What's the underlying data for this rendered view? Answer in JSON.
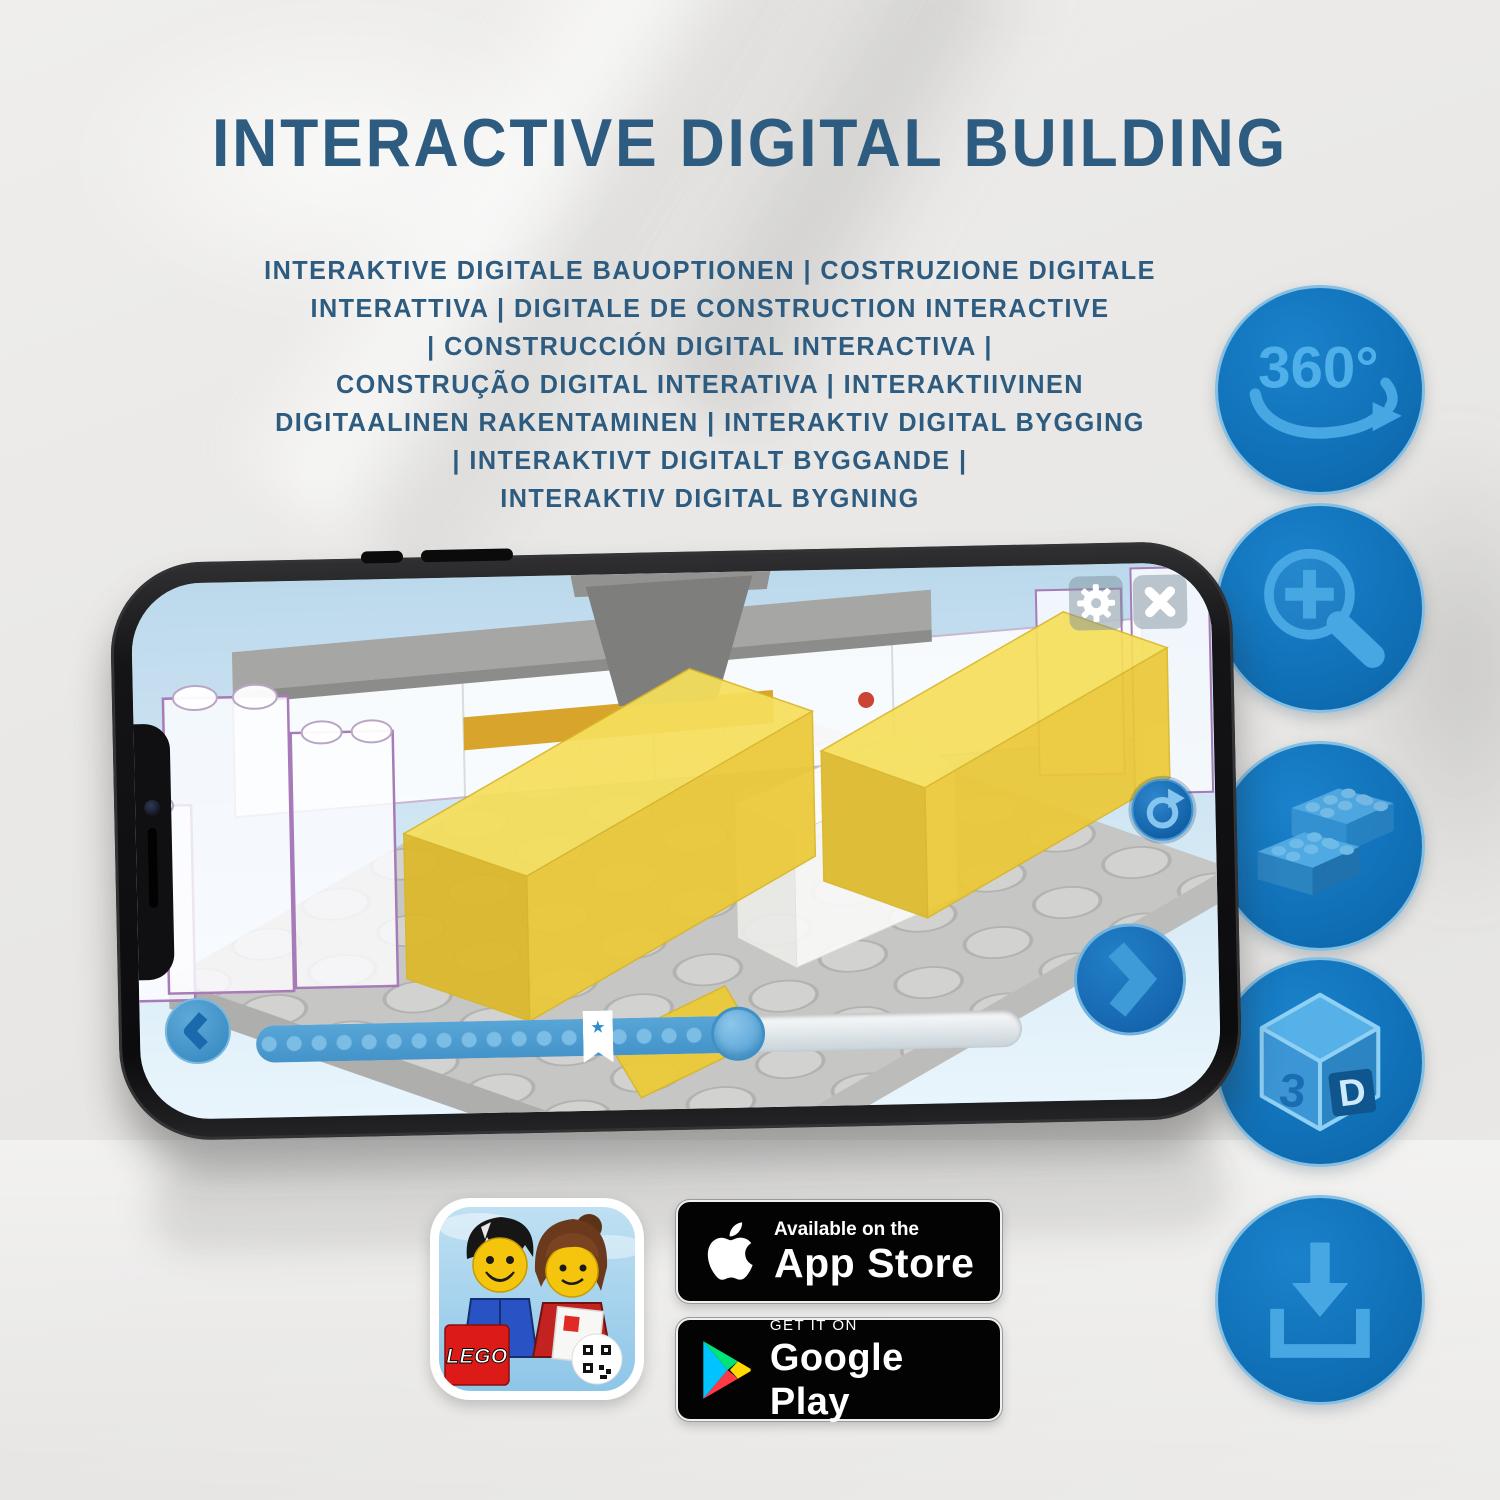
{
  "header": {
    "title": "INTERACTIVE DIGITAL BUILDING",
    "subtitle_lines": [
      "INTERAKTIVE DIGITALE BAUOPTIONEN | COSTRUZIONE DIGITALE",
      "INTERATTIVA | DIGITALE DE CONSTRUCTION INTERACTIVE",
      "| CONSTRUCCIÓN DIGITAL INTERACTIVA |",
      "CONSTRUÇÃO DIGITAL INTERATIVA | INTERAKTIIVINEN",
      "DIGITAALINEN RAKENTAMINEN | INTERAKTIV DIGITAL BYGGING",
      "| INTERAKTIVT DIGITALT BYGGANDE |",
      "INTERAKTIV DIGITAL BYGNING"
    ]
  },
  "feature_icons": {
    "items": [
      "360-rotation",
      "zoom-in",
      "brick-building",
      "3d-view",
      "download"
    ],
    "rotation_label": "360°",
    "cube_left_label": "3",
    "cube_right_label": "D"
  },
  "phone_app": {
    "progress_star": "★"
  },
  "badges": {
    "lego_icon_logo": "LEGO",
    "app_store": {
      "tagline": "Available on the",
      "name": "App Store"
    },
    "google_play": {
      "tagline": "GET IT ON",
      "name": "Google Play"
    }
  },
  "colors": {
    "heading_blue": "#2d5c80",
    "feature_circle_blue": "#1172b9",
    "feature_glyph_blue": "#49a8e2",
    "app_accent_blue": "#1c78c0",
    "screen_sky_blue": "#cfe6f4",
    "progress_fill_blue": "#4e9ed2",
    "lego_yellow": "#f6df5c",
    "badge_black": "#030303"
  }
}
